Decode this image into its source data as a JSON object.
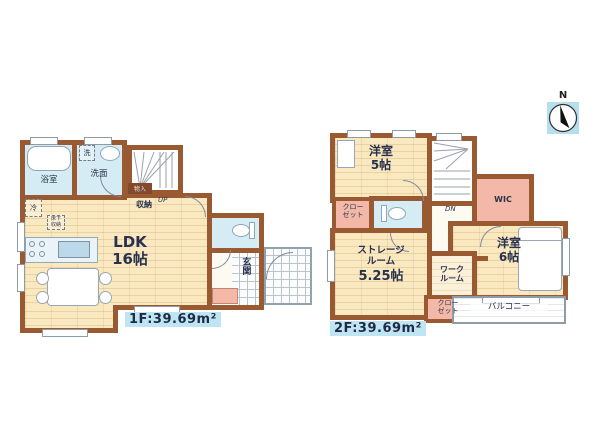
{
  "compass": {
    "north": "N"
  },
  "floor1": {
    "area": "1F:39.69m²",
    "bath": "浴室",
    "washer": "洗",
    "washroom": "洗面",
    "under_stair_cabinet": "物入",
    "storage": "収納",
    "up": "UP",
    "fridge": "冷",
    "floor_storage": [
      "床下",
      "収納"
    ],
    "ldk": [
      "LDK",
      "16帖"
    ],
    "entrance": "玄関"
  },
  "floor2": {
    "area": "2F:39.69m²",
    "bedroom5": [
      "洋室",
      "5帖"
    ],
    "closet_a": [
      "クロー",
      "ゼット"
    ],
    "wic": "WIC",
    "dn": "DN",
    "bedroom6": [
      "洋室",
      "6帖"
    ],
    "storage_room": [
      "ストレージ",
      "ルーム",
      "5.25帖"
    ],
    "work_room": [
      "ワーク",
      "ルーム"
    ],
    "closet_b": [
      "クロー",
      "ゼット"
    ],
    "balcony": "バルコニー"
  },
  "colors": {
    "wall": "#9a5a31",
    "floor": "#f9e8c0",
    "wet_area": "#d6ecf4",
    "closet_pink": "#f3b8a7",
    "area_label_bg": "#bfe4f2",
    "text": "#28324e"
  }
}
